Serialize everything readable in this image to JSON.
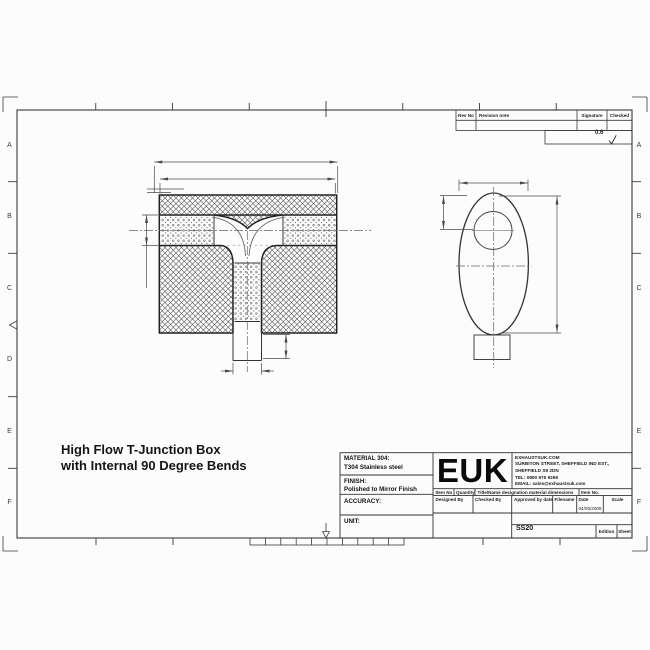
{
  "sheet": {
    "grid_letters_left": [
      "A",
      "B",
      "C",
      "D",
      "E",
      "F"
    ],
    "grid_letters_right": [
      "A",
      "B",
      "C",
      "E",
      "F"
    ],
    "surface_finish_value": "0.6"
  },
  "revision_table": {
    "rev_no": "Rev No",
    "revision_note": "Revision note",
    "signature": "Signature",
    "checked": "Checked"
  },
  "drawing_title": {
    "line1": "High Flow T-Junction Box",
    "line2": "with Internal 90 Degree Bends"
  },
  "title_block": {
    "material_label": "MATERIAL 304:",
    "material_value": "T304 Stainless steel",
    "finish_label": "FINISH:",
    "finish_value": "Polished to Mirror Finish",
    "accuracy_label": "ACCURACY:",
    "unit_label": "UNIT:",
    "logo": "EUK",
    "company_line1": "EXHAUSTSUK.COM",
    "company_line2": "SURBITON STREET, SHEFFIELD IND EST.,",
    "company_line3": "SHEFFIELD S9 2DN",
    "company_line4": "TEL: 0800 975 9268",
    "company_line5": "EMAIL: sales@exhaustsuk.com",
    "col_item_no": "Item No",
    "col_quantity": "Quantity",
    "col_title": "Title/Name designation material dimensions",
    "col_item_no2": "Item No.",
    "col_designed": "Designed By",
    "col_checked": "Checked By",
    "col_approved": "Approved by date",
    "col_filename": "Filename",
    "col_date": "Date",
    "col_scale": "Scale",
    "date_value": "04/06/2009",
    "filename_value": "SS20",
    "edition_label": "Edition",
    "sheet_label": "Sheet"
  }
}
